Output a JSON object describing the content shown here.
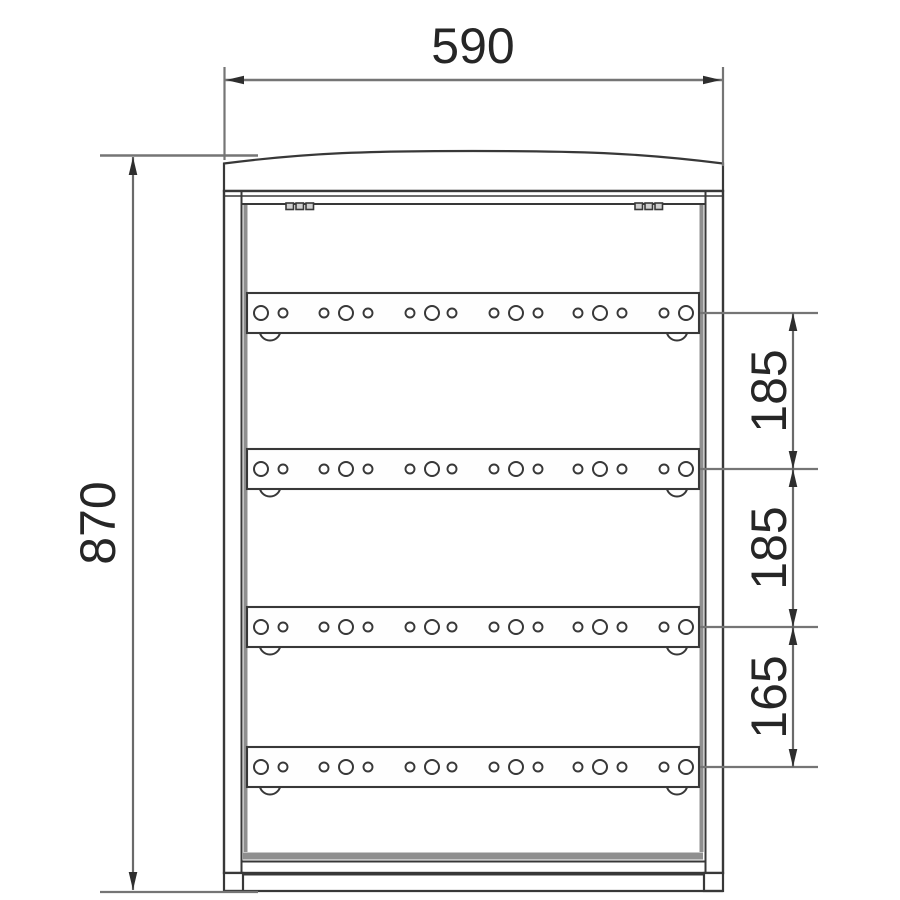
{
  "labels": {
    "width": "590",
    "height": "870",
    "spacing_1": "185",
    "spacing_2": "185",
    "spacing_3": "165"
  },
  "colors": {
    "line": "#383838",
    "shade": "#8f8f8f",
    "dim": "#757575",
    "arrow": "#2e2e2e",
    "text": "#262626",
    "fill": "#ffffff"
  },
  "geometry": {
    "rails": {
      "count": 4,
      "x": 247,
      "width": 452,
      "height": 40,
      "centers_y": [
        313,
        469,
        627,
        767
      ]
    },
    "holes": {
      "large": {
        "r": 7,
        "x": [
          261,
          346,
          432,
          516,
          600,
          686
        ]
      },
      "small": {
        "r": 4.5,
        "x": [
          283,
          324,
          368,
          410,
          452,
          494,
          538,
          578,
          622,
          664
        ]
      }
    },
    "tabs": {
      "r": 10.5,
      "x": [
        270,
        677
      ]
    },
    "vents": {
      "y": 203,
      "w": 7.5,
      "h": 6.5,
      "x": [
        286,
        296,
        306,
        635,
        645,
        655
      ]
    },
    "dim_right": {
      "line_x": 793,
      "ext_x1": 700,
      "ext_x2": 818,
      "text_x": 786,
      "segments": [
        {
          "from_y": 313,
          "to_y": 469,
          "label_key": "spacing_1"
        },
        {
          "from_y": 469,
          "to_y": 627,
          "label_key": "spacing_2"
        },
        {
          "from_y": 627,
          "to_y": 767,
          "label_key": "spacing_3"
        }
      ]
    }
  }
}
